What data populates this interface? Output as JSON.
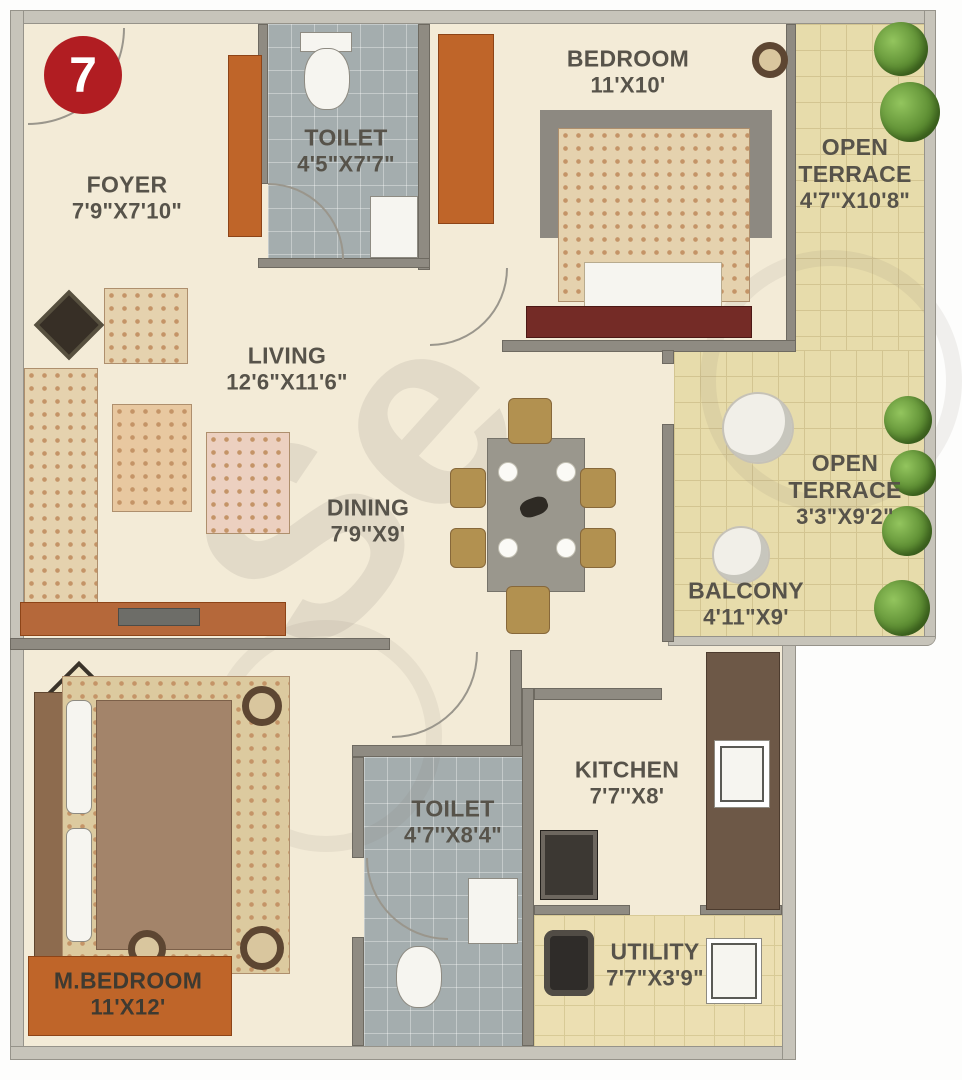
{
  "badge": {
    "number": "7"
  },
  "watermark": {
    "text": "Se"
  },
  "rooms": {
    "foyer": {
      "name": "FOYER",
      "dims": "7'9\"X7'10\""
    },
    "toilet_top": {
      "name": "TOILET",
      "dims": "4'5\"X7'7\""
    },
    "bedroom": {
      "name": "BEDROOM",
      "dims": "11'X10'"
    },
    "open_terrace_top": {
      "line1": "OPEN",
      "line2": "TERRACE",
      "dims": "4'7\"X10'8\""
    },
    "living": {
      "name": "LIVING",
      "dims": "12'6\"X11'6\""
    },
    "dining": {
      "name": "DINING",
      "dims": "7'9''X9'"
    },
    "open_terrace_mid": {
      "line1": "OPEN",
      "line2": "TERRACE",
      "dims": "3'3\"X9'2\""
    },
    "balcony": {
      "name": "BALCONY",
      "dims": "4'11\"X9'"
    },
    "master_bedroom": {
      "name": "M.BEDROOM",
      "dims": "11'X12'"
    },
    "toilet_bottom": {
      "name": "TOILET",
      "dims": "4'7''X8'4\""
    },
    "kitchen": {
      "name": "KITCHEN",
      "dims": "7'7''X8'"
    },
    "utility": {
      "name": "UTILITY",
      "dims": "7'7\"X3'9\""
    }
  },
  "colors": {
    "badge_red": "#b11d22",
    "floor_cream": "#f3ebd7",
    "terrace_tile": "#e7dcab",
    "toilet_tile": "#a4adae",
    "furniture_orange": "#bf6529",
    "wall_gray": "#8f8b82",
    "label_text": "#57534a"
  }
}
